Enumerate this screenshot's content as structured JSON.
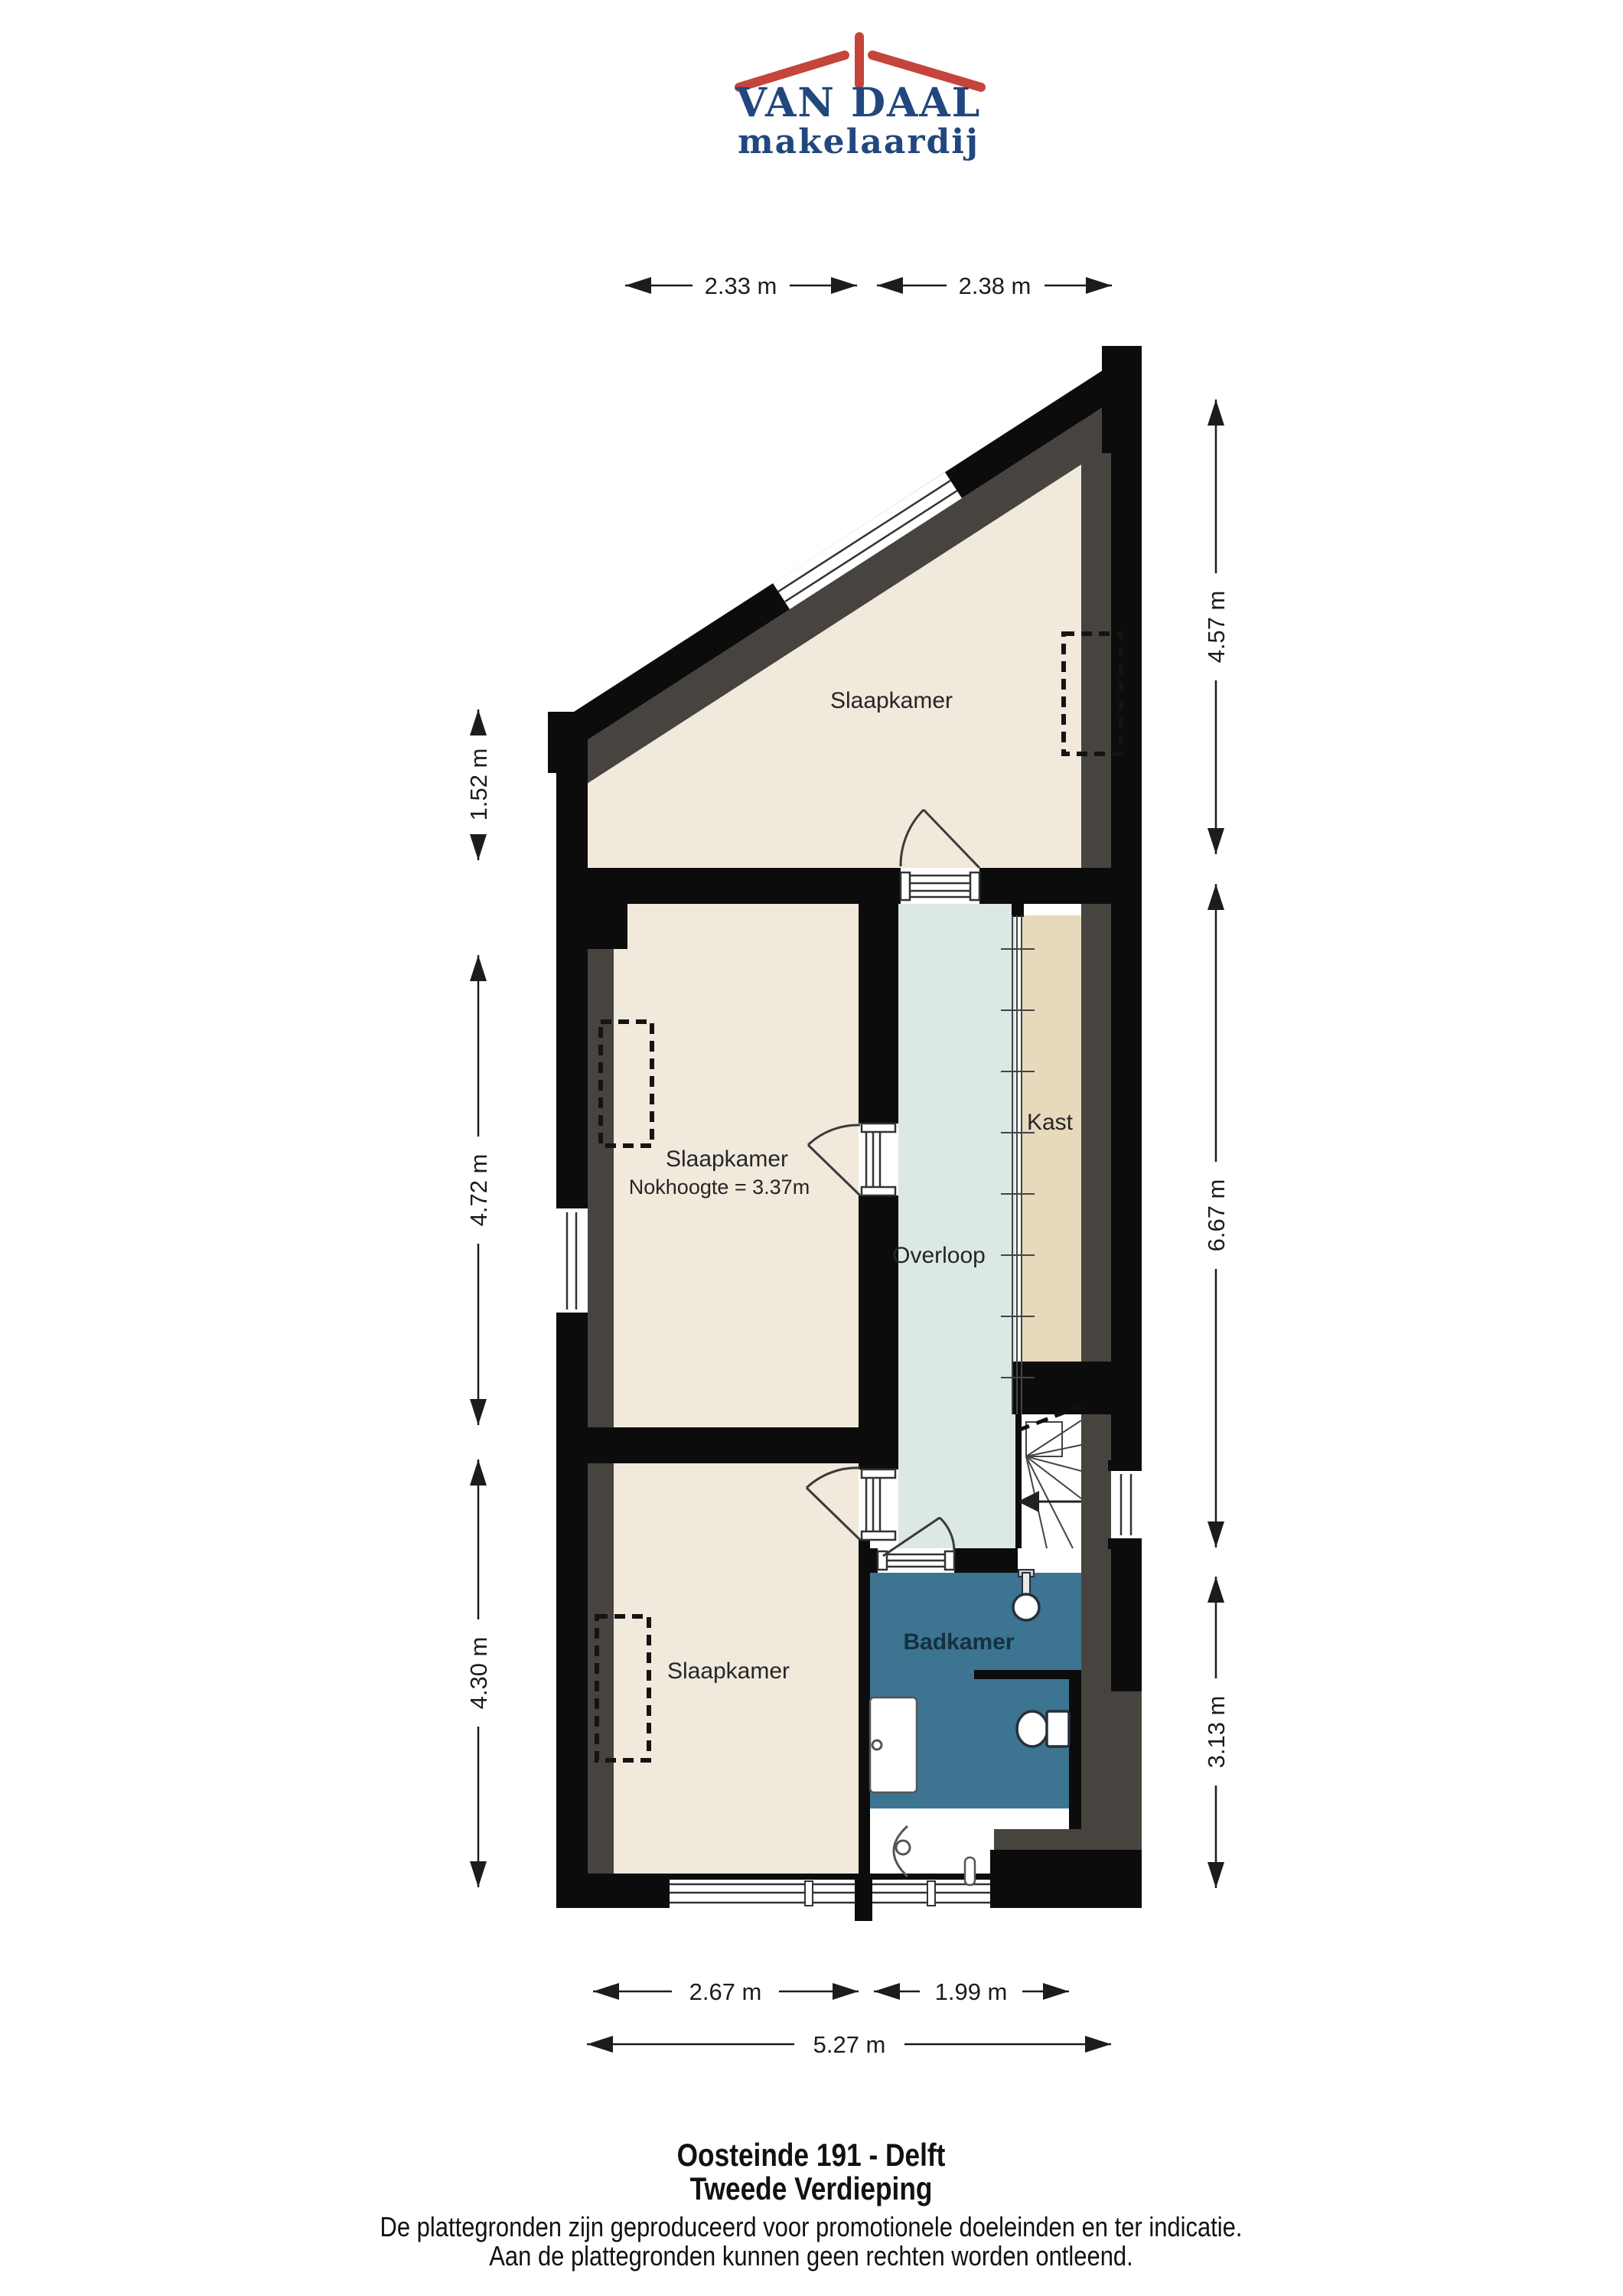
{
  "logo": {
    "brand": "VAN DAAL",
    "subtitle": "makelaardij"
  },
  "plan": {
    "rooms": {
      "bedroom_top": "Slaapkamer",
      "bedroom_middle": "Slaapkamer",
      "bedroom_middle_note": "Nokhoogte = 3.37m",
      "bedroom_bottom": "Slaapkamer",
      "closet": "Kast",
      "landing": "Overloop",
      "bathroom": "Badkamer"
    }
  },
  "dimensions": {
    "top": [
      "2.33 m",
      "2.38 m"
    ],
    "right": [
      "4.57 m",
      "6.67 m",
      "3.13 m"
    ],
    "left": [
      "1.52 m",
      "4.72 m",
      "4.30 m"
    ],
    "bottom": [
      "2.67 m",
      "1.99 m",
      "5.27 m"
    ]
  },
  "footer": {
    "address": "Oosteinde 191 - Delft",
    "floor": "Tweede Verdieping",
    "disclaimer_line1": "De plattegronden zijn geproduceerd voor promotionele doeleinden en ter indicatie.",
    "disclaimer_line2": "Aan de plattegronden kunnen geen rechten worden ontleend."
  },
  "colors": {
    "wall_black": "#0c0c0c",
    "low_headroom_gray": "#47443f",
    "floor_beige": "#f0e9dc",
    "closet_tan": "#e7d9bc",
    "landing_blue": "#dce8e5",
    "bathroom_blue": "#3c7492",
    "logo_blue": "#21477e",
    "logo_red": "#c5443c"
  }
}
